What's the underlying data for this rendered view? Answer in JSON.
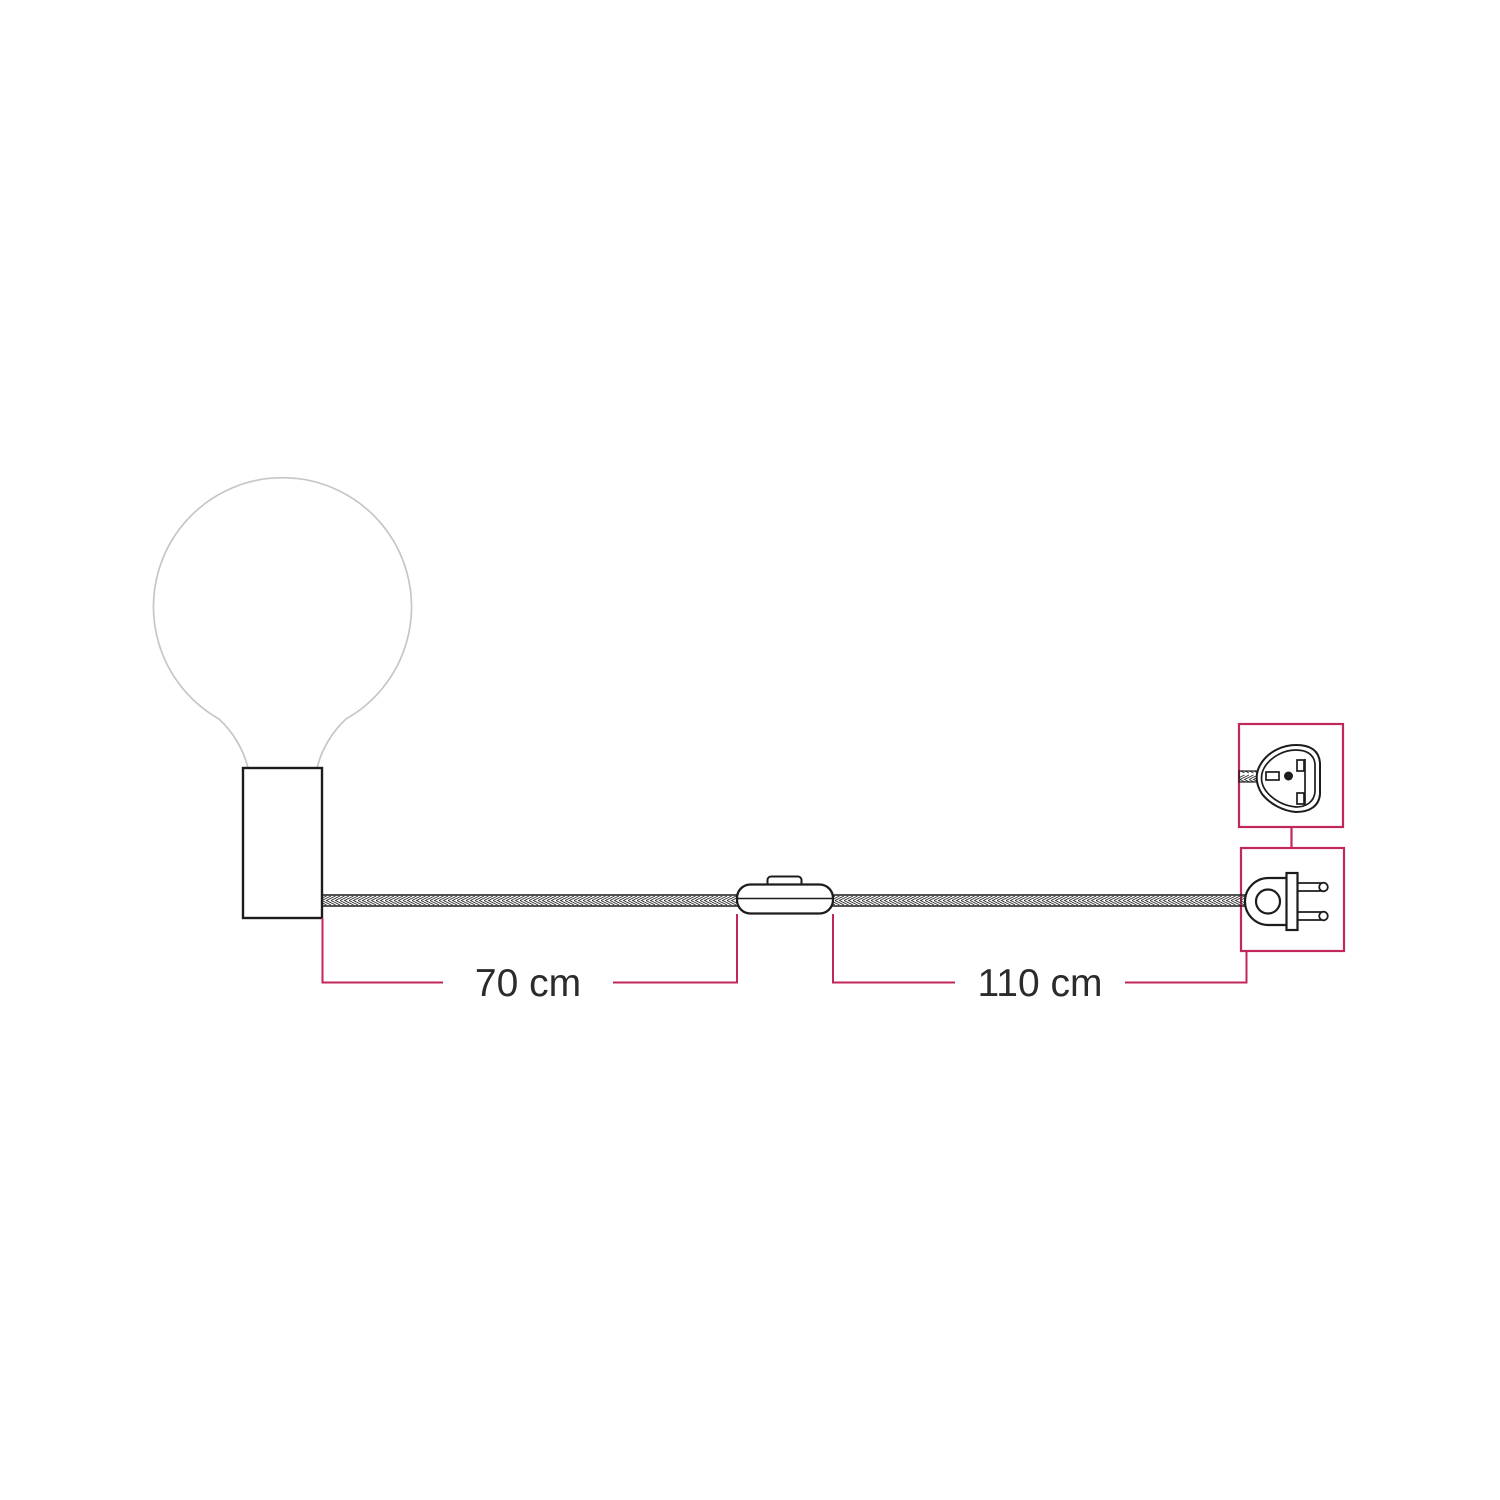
{
  "diagram": {
    "kind": "product-dimension-drawing",
    "dimensions": {
      "holder_to_switch": "70 cm",
      "switch_to_plug": "110 cm"
    },
    "icons": [
      {
        "name": "globe-bulb-icon"
      },
      {
        "name": "lamp-holder-icon"
      },
      {
        "name": "braided-cable-icon"
      },
      {
        "name": "inline-switch-icon"
      },
      {
        "name": "plug-front-view-icon"
      },
      {
        "name": "plug-side-view-icon"
      }
    ],
    "colors": {
      "accent_pink": "#c2265f",
      "line_dark": "#1c1c1c",
      "bulb_gray": "#c6c6c6",
      "text_dark": "#2b2b2b",
      "background": "#ffffff"
    }
  }
}
